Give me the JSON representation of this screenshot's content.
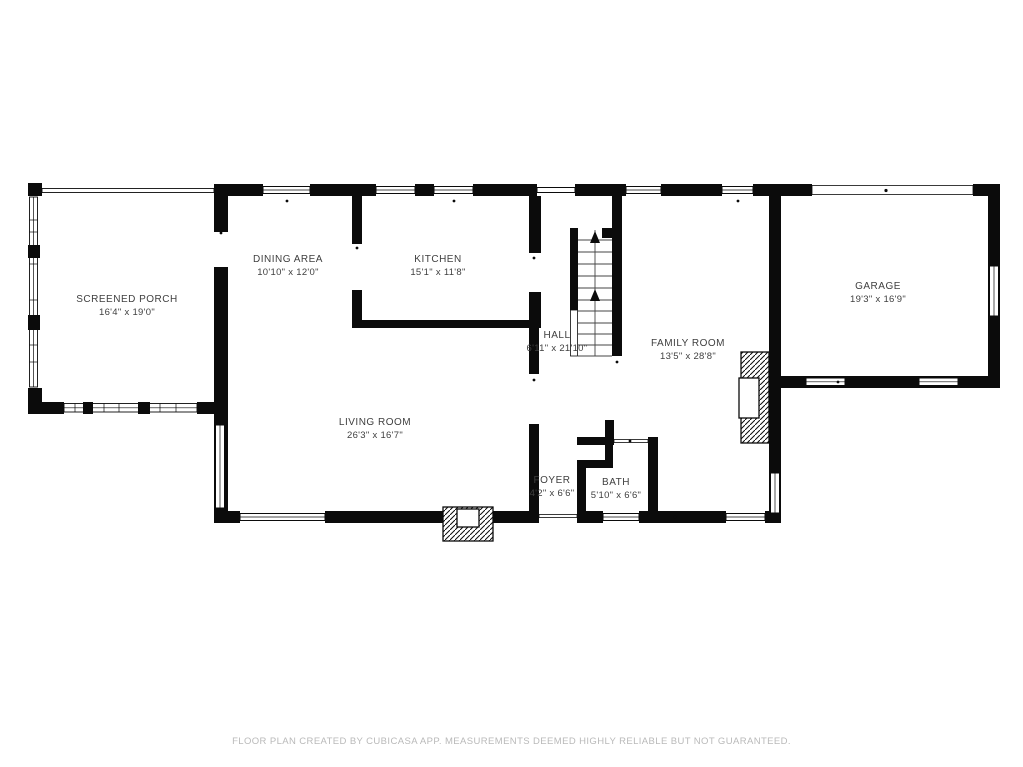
{
  "rooms": [
    {
      "id": "screened-porch",
      "name": "SCREENED PORCH",
      "dims": "16'4\" x 19'0\""
    },
    {
      "id": "dining-area",
      "name": "DINING AREA",
      "dims": "10'10\" x 12'0\""
    },
    {
      "id": "kitchen",
      "name": "KITCHEN",
      "dims": "15'1\" x 11'8\""
    },
    {
      "id": "hall",
      "name": "HALL",
      "dims": "6'11\" x 21'10\""
    },
    {
      "id": "family-room",
      "name": "FAMILY ROOM",
      "dims": "13'5\" x 28'8\""
    },
    {
      "id": "garage",
      "name": "GARAGE",
      "dims": "19'3\" x 16'9\""
    },
    {
      "id": "living-room",
      "name": "LIVING ROOM",
      "dims": "26'3\" x 16'7\""
    },
    {
      "id": "foyer",
      "name": "FOYER",
      "dims": "4'2\" x 6'6\""
    },
    {
      "id": "bath",
      "name": "BATH",
      "dims": "5'10\" x 6'6\""
    }
  ],
  "footer": {
    "disclaimer": "FLOOR PLAN CREATED BY CUBICASA APP. MEASUREMENTS DEEMED HIGHLY RELIABLE BUT NOT GUARANTEED."
  },
  "icons": {
    "stairs_up_arrow": "up-arrow",
    "fireplace": "hatched-box",
    "window": "double-line-band",
    "garage_door": "thin-band"
  },
  "colors": {
    "background": "#ffffff",
    "wall": "#0b0b0b",
    "label_text": "#3f3f3f",
    "footer_text": "#b9b9b9",
    "stair_line": "#454545"
  }
}
